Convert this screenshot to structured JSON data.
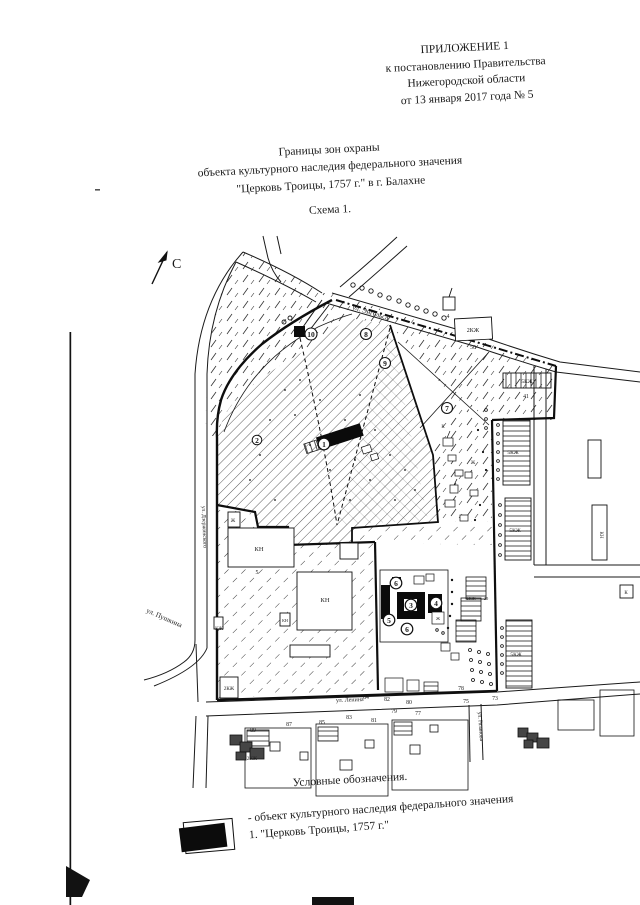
{
  "page": {
    "header": {
      "line1": "ПРИЛОЖЕНИЕ 1",
      "line2": "к постановлению Правительства",
      "line3": "Нижегородской области",
      "line4": "от 13 января 2017 года № 5"
    },
    "title": {
      "line1": "Границы зон охраны",
      "line2": "объекта культурного наследия федерального значения",
      "line3": "\"Церковь Троицы, 1757 г.\" в г. Балахне",
      "schema": "Схема 1."
    }
  },
  "map": {
    "north_label": "С",
    "streets": {
      "engelsa": "ул. Энгельса",
      "pushkina": "ул. Пушкина",
      "west": "ул. Дзержинского",
      "lenina": "ул. Ленина",
      "ryazanova": "ул. Рязанова"
    },
    "markers": {
      "m1": "1",
      "m2": "2",
      "m3": "3",
      "m4": "4",
      "m5": "5",
      "m6": "6",
      "m7": "7",
      "m8": "8",
      "m9": "9",
      "m10": "10"
    },
    "bldg": {
      "kzh2": "2КЖ",
      "kzh5": "5КЖ",
      "kn": "КН",
      "kzh": "КЖ",
      "zh": "Ж",
      "k": "К"
    },
    "nums": {
      "n50": "50",
      "n41": "41",
      "n4": "4",
      "n20": "20",
      "n5": "5",
      "n73": "73",
      "n75": "75",
      "n77": "77",
      "n78": "78",
      "n79": "79",
      "n80": "80",
      "n81": "81",
      "n82": "82",
      "n83": "83",
      "n84": "84",
      "n85": "85",
      "n87": "87",
      "n89": "89"
    }
  },
  "legend": {
    "heading": "Условные обозначения.",
    "item": {
      "line1": "- объект культурного наследия федерального значения",
      "line2": "1. \"Церковь Троицы, 1757 г.\""
    }
  }
}
